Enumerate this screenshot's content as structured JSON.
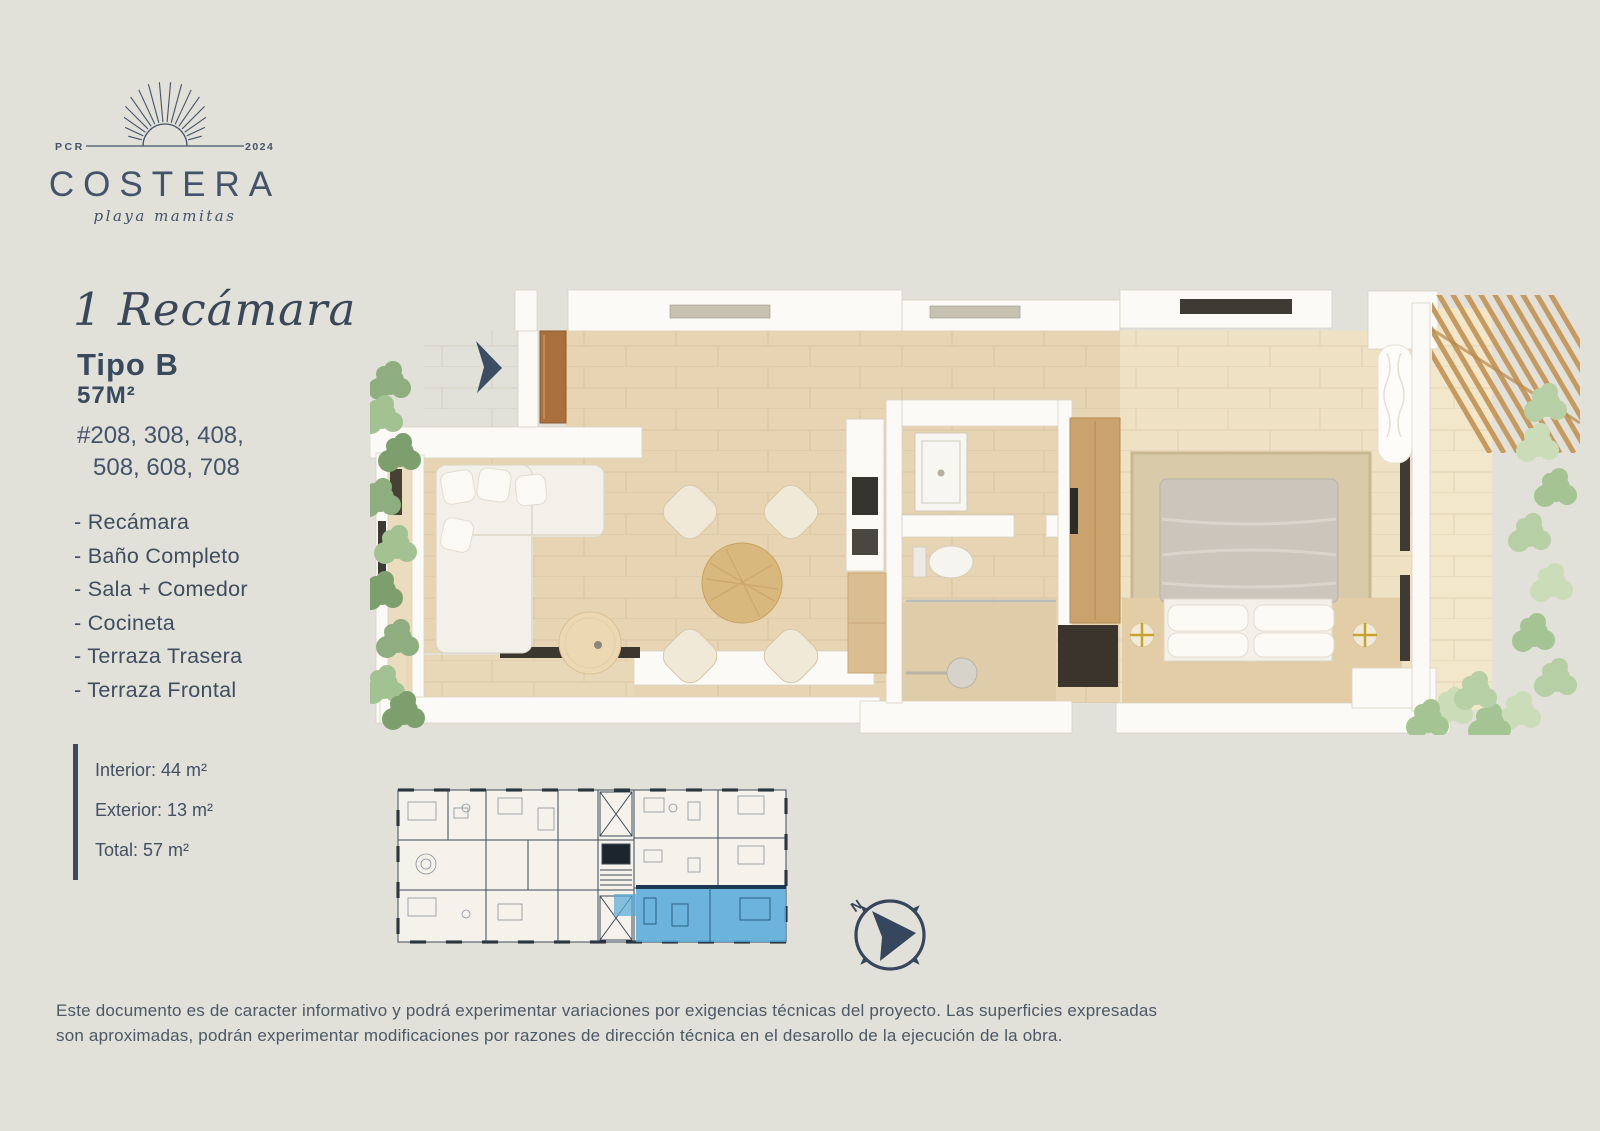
{
  "page": {
    "background": "#e1e0d9",
    "navy": "#394a5e",
    "highlight_blue": "#55a9d9",
    "floor_wood": "#e7d4b2",
    "bedroom_wood": "#efe1c4"
  },
  "logo": {
    "left_label": "PCR",
    "right_label": "2024",
    "brand": "COSTERA",
    "tagline": "playa mamitas"
  },
  "unit": {
    "title": "1 Recámara",
    "type_label": "Tipo B",
    "area_label": "57M²",
    "unit_numbers_line1": "#208, 308, 408,",
    "unit_numbers_line2": "508, 608, 708",
    "features": [
      "- Recámara",
      "- Baño Completo",
      "- Sala + Comedor",
      "- Cocineta",
      "- Terraza Trasera",
      "- Terraza Frontal"
    ],
    "measurements": {
      "interior": "Interior: 44 m²",
      "exterior": "Exterior: 13 m²",
      "total": "Total: 57 m²"
    }
  },
  "compass": {
    "north_label": "N"
  },
  "disclaimer": {
    "line1": "Este documento es de caracter informativo y podrá experimentar variaciones por exigencias técnicas del proyecto. Las superficies expresadas",
    "line2": "son aproximadas, podrán experimentar modificaciones por razones de dirección técnica en el desarollo de la ejecución de la obra."
  }
}
